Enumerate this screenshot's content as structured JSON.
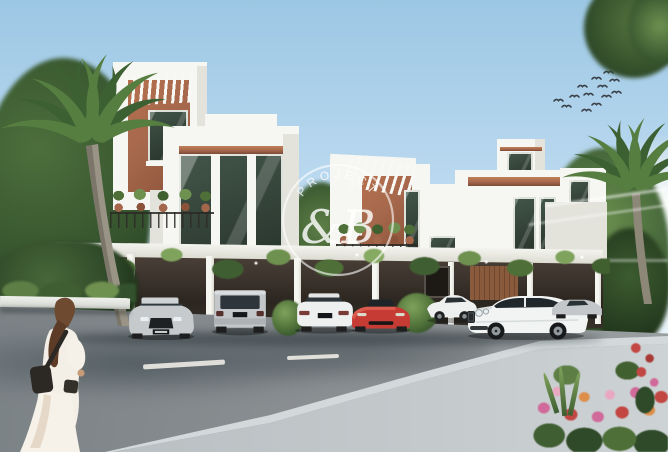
{
  "image": {
    "kind": "architectural-rendering",
    "description": "Row of modern white townhouses with wood pergolas and covered parking; luxury cars parked in front; palm trees; a woman in a white dress walking along the street; flowers in the foreground; birds in the sky"
  },
  "watermark": {
    "arc_text": "PROJECT",
    "monogram": "&B"
  },
  "colors": {
    "sky_top": "#9cc7e4",
    "sky_mid": "#bcdaf0",
    "sky_horizon": "#e6f2f9",
    "white_wall": "#f6f6f2",
    "wall_shade": "#e3e3db",
    "wood": "#a5674c",
    "glass_dark": "#36453b",
    "curb": "#d3d9da",
    "lane_mark": "#edebe4",
    "car_silver": "#c7cacc",
    "car_white": "#f1f2f2",
    "car_red": "#c63c34",
    "flower_pink": "#d06a9a",
    "flower_red": "#c24743",
    "flower_orange": "#dd8f4a",
    "bird": "#3a4148",
    "hair": "#6e4a31",
    "dress": "#f3efe6",
    "bag": "#2c2824"
  }
}
